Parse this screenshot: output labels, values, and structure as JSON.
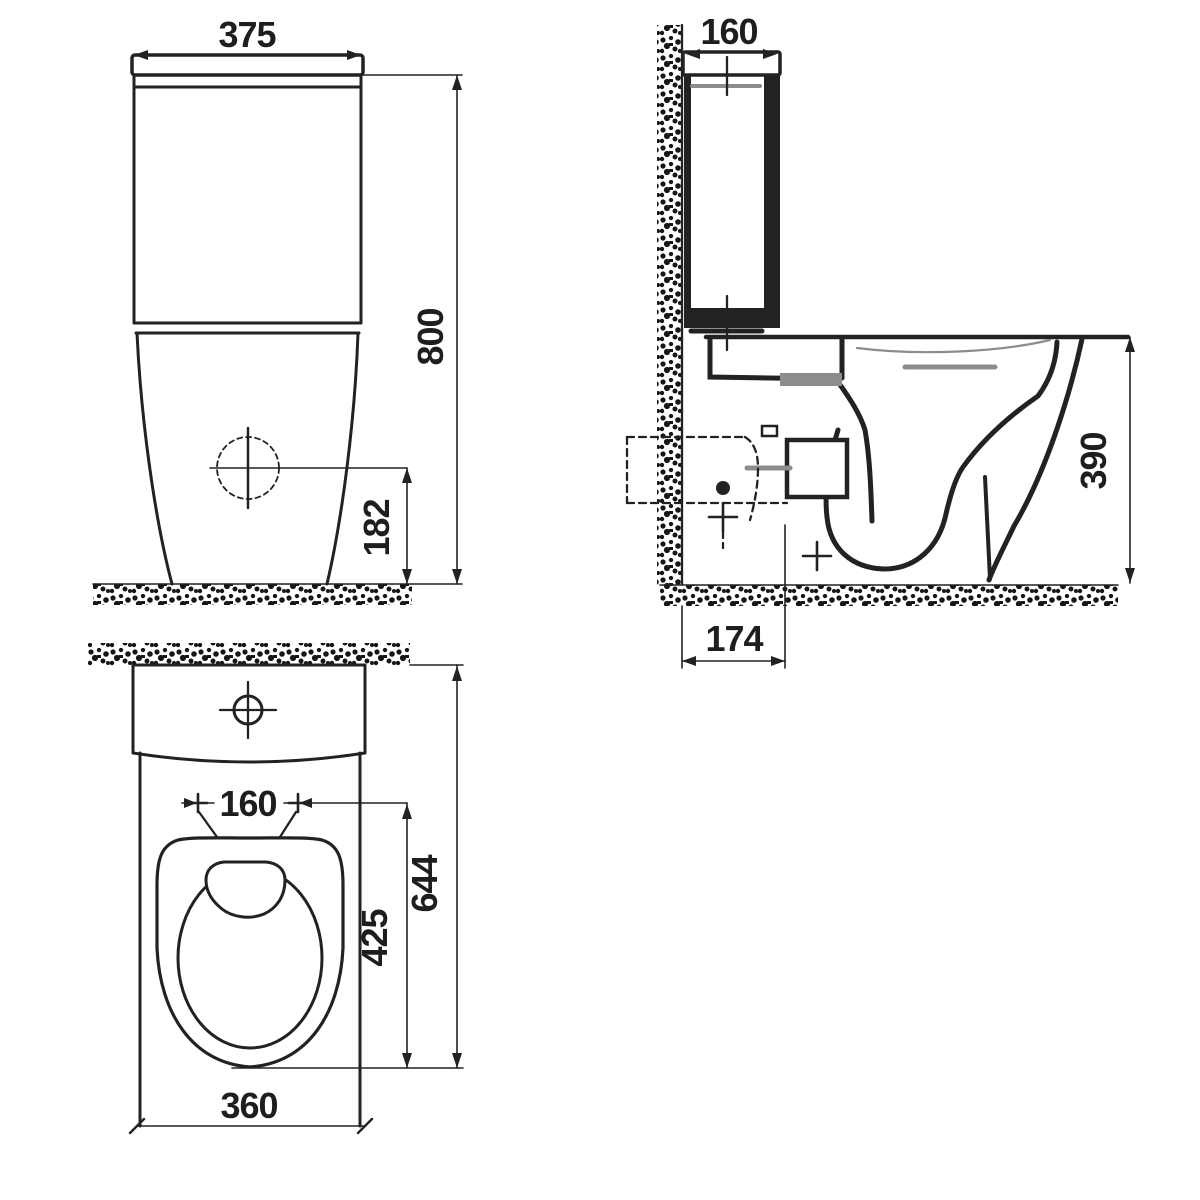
{
  "drawing": {
    "description": "Three-view technical dimension drawing of a close-coupled toilet (WC) with cistern: front elevation, side section, and plan view",
    "colors": {
      "line": "#222222",
      "gray": "#8c8c8c",
      "background": "#ffffff"
    },
    "labels": {
      "front_width": "375",
      "front_height": "800",
      "front_inlet_height": "182",
      "side_cistern_depth": "160",
      "side_rim_height": "390",
      "side_outlet_offset": "174",
      "plan_hole_spacing": "160",
      "plan_overall_depth": "644",
      "plan_seat_depth": "425",
      "plan_front_width": "360"
    }
  }
}
